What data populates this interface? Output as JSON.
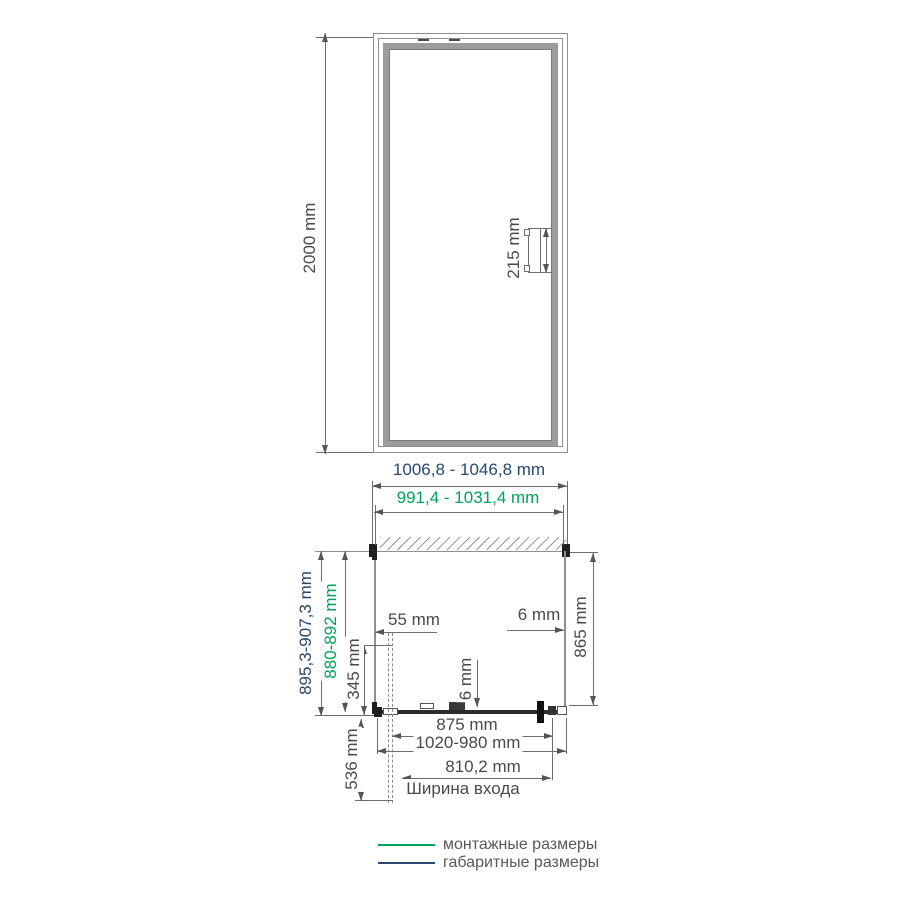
{
  "front_view": {
    "height": "2000 mm",
    "handle_height": "215 mm"
  },
  "plan_view": {
    "overall_width": "1006,8 - 1046,8 mm",
    "mounting_width": "991,4 - 1031,4 mm",
    "overall_depth": "895,3-907,3 mm",
    "mounting_depth": "880-892 mm",
    "wall_to_glass_offset": "55 mm",
    "fixed_panel_depth": "345 mm",
    "side_glass_thickness": "6 mm",
    "door_glass_thickness": "6 mm",
    "inner_depth": "865 mm",
    "door_width": "875 mm",
    "adjustment_range": "1020-980 mm",
    "entrance_width": "810,2 mm",
    "entrance_width_caption": "Ширина входа",
    "door_projection": "536 mm"
  },
  "legend": {
    "items": [
      {
        "label": "монтажные размеры",
        "color": "#00a35c"
      },
      {
        "label": "габаритные размеры",
        "color": "#27496d"
      }
    ]
  },
  "colors": {
    "mounting_dimension_color": "#00a35c",
    "overall_dimension_color": "#27496d",
    "dimension_text_color": "#4a4a4a",
    "drawing_line_color": "#8f8f8f"
  }
}
